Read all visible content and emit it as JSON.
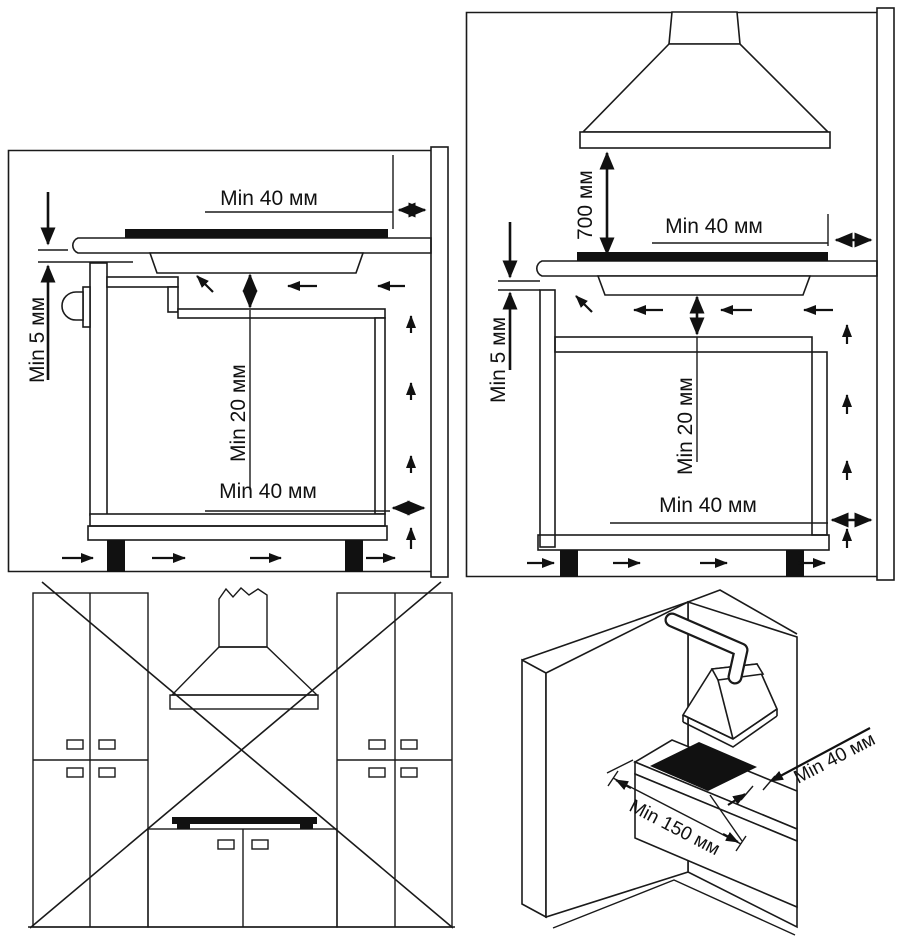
{
  "diagram": {
    "title": "Hob installation clearances diagram",
    "colors": {
      "line": "#1a1a1a",
      "filled_hob": "#111111",
      "background": "#ffffff"
    },
    "panel1": {
      "name": "side view - built-in hob in worktop",
      "labels": {
        "top": "Min 40 мм",
        "side": "Min 5 мм",
        "under": "Min 20 мм",
        "bottom": "Min 40 мм"
      }
    },
    "panel2": {
      "name": "side view with cooker hood",
      "labels": {
        "hood": "700 мм",
        "top": "Min 40 мм",
        "side": "Min 5 мм",
        "under": "Min 20 мм",
        "bottom": "Min 40 мм"
      }
    },
    "panel3": {
      "name": "front view - incorrect installation crossed out"
    },
    "panel4": {
      "name": "corner installation isometric view",
      "labels": {
        "wall": "Min 40 мм",
        "front": "Min 150 мм"
      }
    }
  }
}
